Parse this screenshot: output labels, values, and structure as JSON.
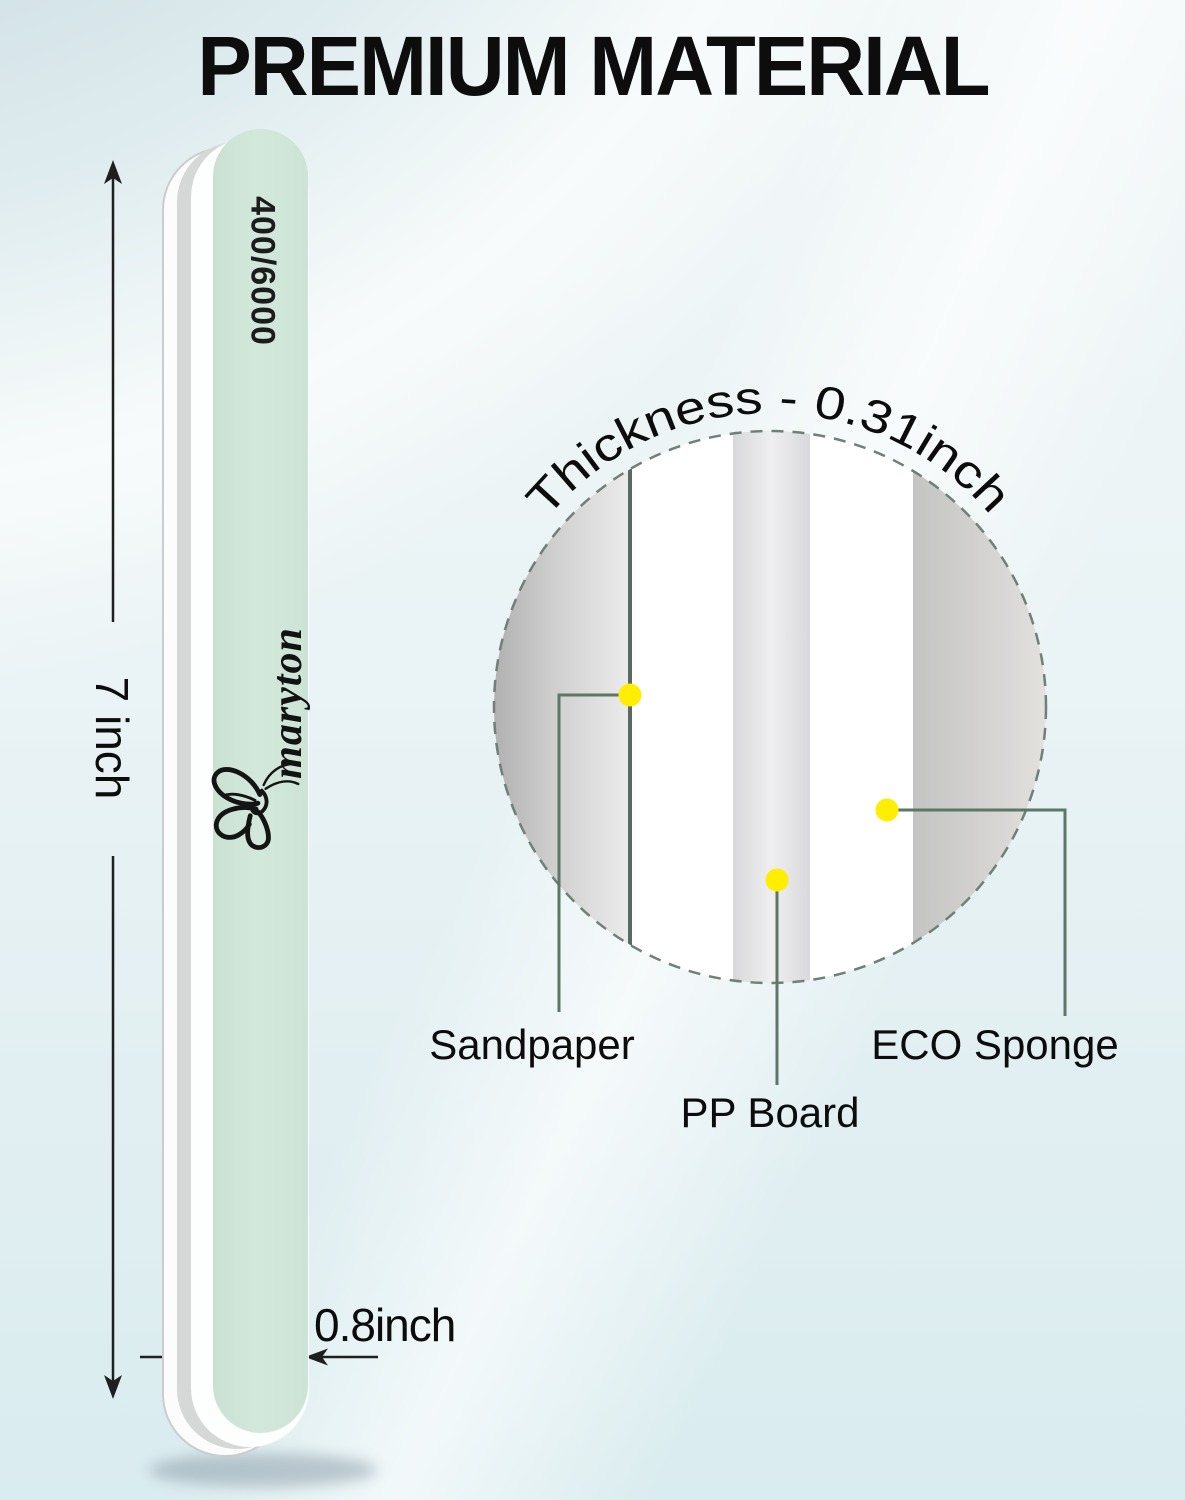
{
  "title": "PREMIUM MATERIAL",
  "nail_file": {
    "grit_label": "400/6000",
    "brand": "maryton",
    "length_label": "7 inch",
    "width_label": "0.8inch"
  },
  "cross_section": {
    "arc_label": "Thickness - 0.31inch",
    "layer_labels": {
      "sandpaper": "Sandpaper",
      "pp_board": "PP Board",
      "eco_sponge": "ECO Sponge"
    }
  },
  "colors": {
    "file_face_green": "#cee5d7",
    "marker_dot_yellow": "#ffee00",
    "callout_line_green": "#5d7767",
    "dashed_circle_green": "#6f8077"
  }
}
